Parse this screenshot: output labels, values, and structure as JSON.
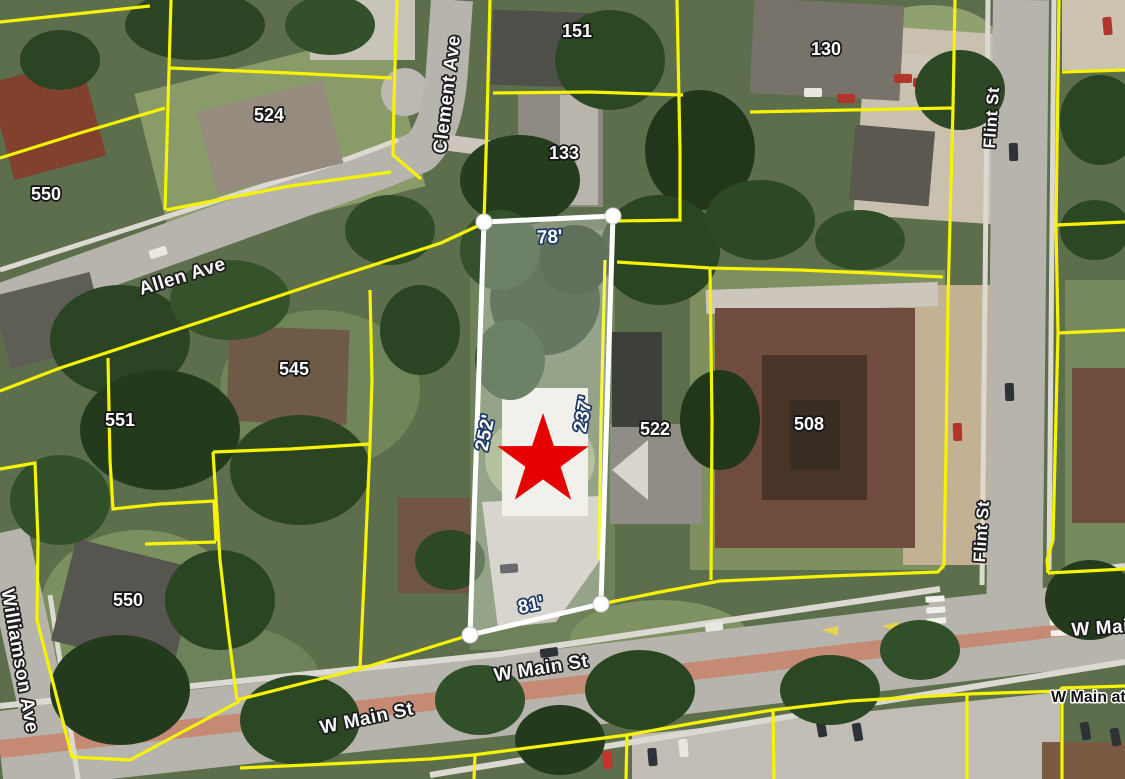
{
  "map": {
    "type": "aerial-parcel-viewer",
    "description": "Satellite basemap with yellow parcel boundaries, one selected parcel outlined in white with edge dimensions, red star marker on subject property"
  },
  "labels": {
    "streets": [
      {
        "id": "clement-ave",
        "text": "Clement Ave"
      },
      {
        "id": "allen-ave",
        "text": "Allen Ave"
      },
      {
        "id": "flint-st-north",
        "text": "Flint St"
      },
      {
        "id": "flint-st-south",
        "text": "Flint St"
      },
      {
        "id": "w-main-st-left",
        "text": "W Main St"
      },
      {
        "id": "w-main-st-center",
        "text": "W Main St"
      },
      {
        "id": "w-main-st-right",
        "text": "W Main St"
      }
    ],
    "house_numbers": [
      {
        "text": "151"
      },
      {
        "text": "130"
      },
      {
        "text": "524"
      },
      {
        "text": "550"
      },
      {
        "text": "133"
      },
      {
        "text": "545"
      },
      {
        "text": "551"
      },
      {
        "text": "522"
      },
      {
        "text": "508"
      },
      {
        "text": "550"
      }
    ],
    "poi": {
      "text": "W Main at"
    }
  },
  "selected_parcel": {
    "dimensions": [
      {
        "side": "north",
        "text": "78'"
      },
      {
        "side": "west",
        "text": "252'"
      },
      {
        "side": "east",
        "text": "237'"
      },
      {
        "side": "south",
        "text": "81'"
      }
    ],
    "fill": "rgba(255,255,255,0.28)",
    "outline_color": "#ffffff",
    "handle_color": "#ffffff"
  },
  "marker": {
    "shape": "star",
    "color": "#e60000"
  },
  "colors": {
    "parcel_line": "#f6f300",
    "road": "#b7b4ad",
    "median": "#c48a74",
    "dimension_halo": "#1d3766",
    "label_halo": "#141414"
  }
}
